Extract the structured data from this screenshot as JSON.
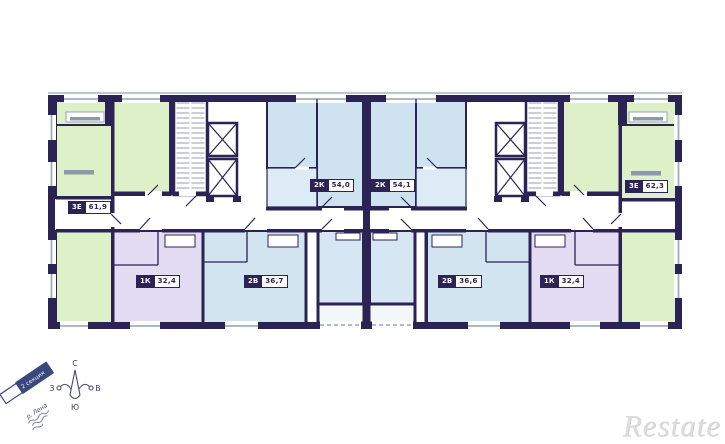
{
  "plan": {
    "units": [
      {
        "type": "3Е",
        "area": "61,9",
        "color_key": "green"
      },
      {
        "type": "2К",
        "area": "54,0",
        "color_key": "blue"
      },
      {
        "type": "2К",
        "area": "54,1",
        "color_key": "blue"
      },
      {
        "type": "3Е",
        "area": "62,3",
        "color_key": "green"
      },
      {
        "type": "1К",
        "area": "32,4",
        "color_key": "purple"
      },
      {
        "type": "2В",
        "area": "36,7",
        "color_key": "blue"
      },
      {
        "type": "2В",
        "area": "36,6",
        "color_key": "blue"
      },
      {
        "type": "1К",
        "area": "32,4",
        "color_key": "purple"
      }
    ],
    "colors": {
      "wall": "#2b2353",
      "green_room": "#def0c8",
      "blue_room": "#cfe2f0",
      "blue_room_light": "#dcebf6",
      "purple_room": "#e3dcf2",
      "corridor": "#ffffff",
      "window_line": "#9fb0bd"
    }
  },
  "compass": {
    "north": "С",
    "south": "Ю",
    "west": "З",
    "east": "В"
  },
  "section_ribbon": {
    "label": "2 секция"
  },
  "river": {
    "label": "р. Лена"
  },
  "watermark": {
    "text": "Restate"
  }
}
